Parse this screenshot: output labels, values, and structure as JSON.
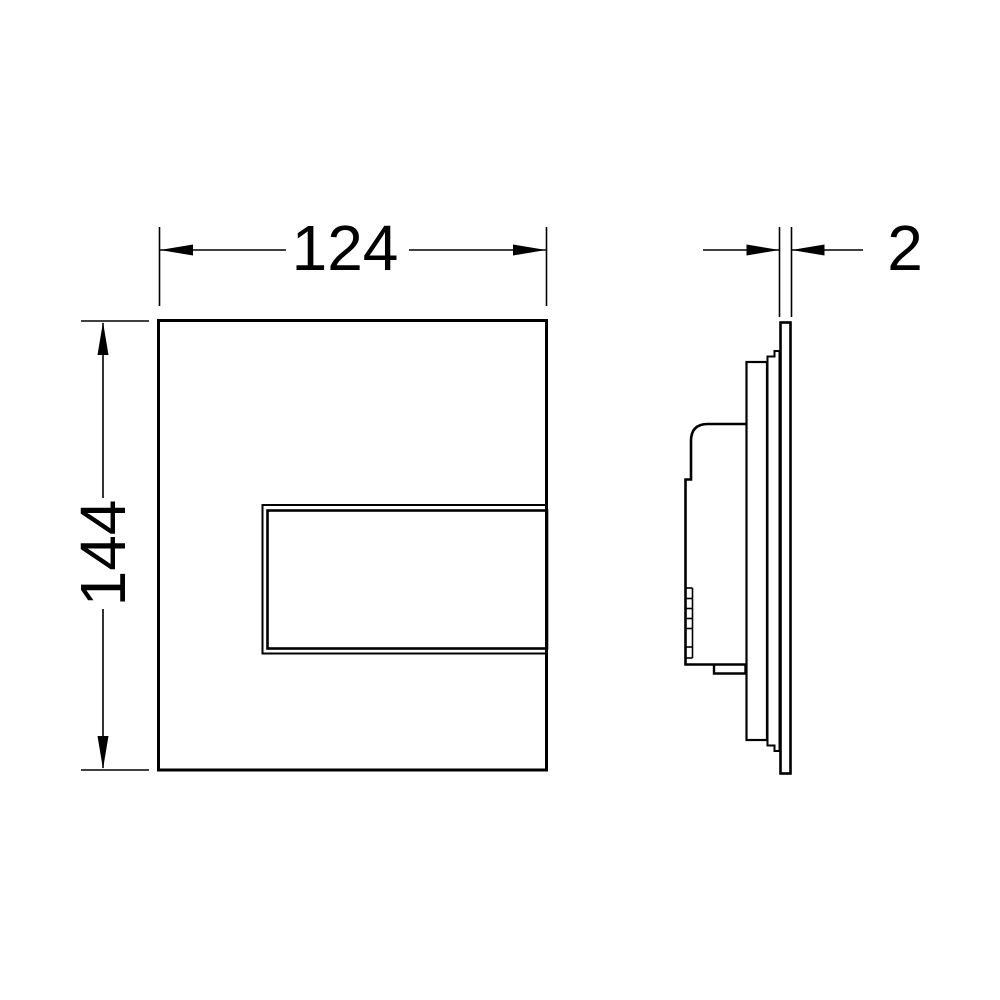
{
  "colors": {
    "background": "#ffffff",
    "line": "#000000"
  },
  "front_view": {
    "width_dimension": {
      "label": "124"
    },
    "height_dimension": {
      "label": "144"
    }
  },
  "side_view": {
    "thickness_dimension": {
      "label": "2"
    }
  }
}
